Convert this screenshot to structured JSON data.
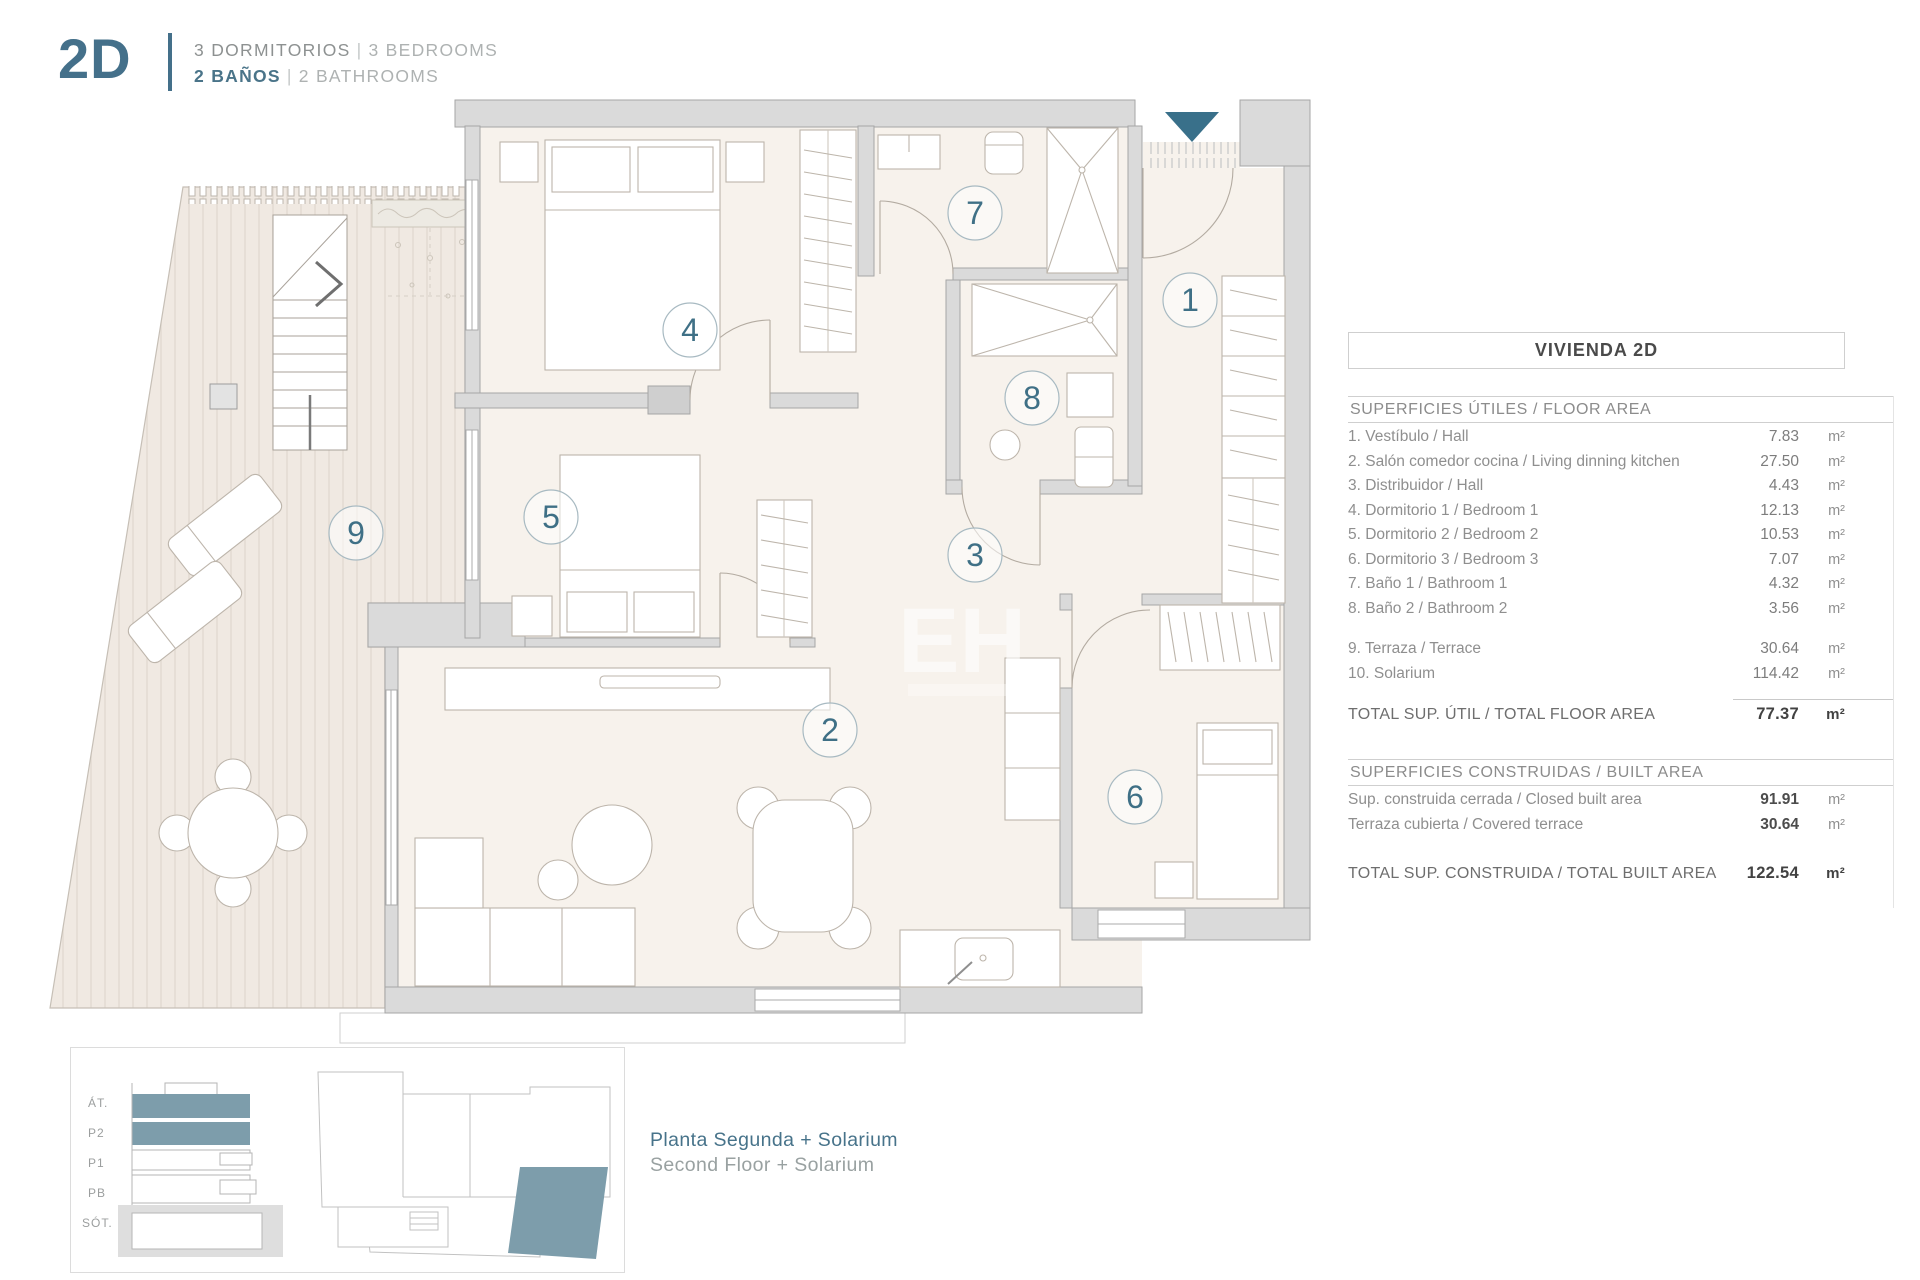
{
  "header": {
    "unit": "2D",
    "line1_primary": "3 DORMITORIOS",
    "sep": "|",
    "line1_secondary": "3 BEDROOMS",
    "line2_primary": "2 BAÑOS",
    "line2_secondary": "2 BATHROOMS"
  },
  "area_table": {
    "title": "VIVIENDA 2D",
    "unit_symbol": "m²",
    "floor_section": {
      "heading": "SUPERFICIES ÚTILES / FLOOR AREA",
      "rows": [
        {
          "label": "1. Vestíbulo / Hall",
          "value": "7.83",
          "unit": "m²"
        },
        {
          "label": "2. Salón comedor cocina / Living dinning kitchen",
          "value": "27.50",
          "unit": "m²"
        },
        {
          "label": "3. Distribuidor / Hall",
          "value": "4.43",
          "unit": "m²"
        },
        {
          "label": "4. Dormitorio 1 / Bedroom 1",
          "value": "12.13",
          "unit": "m²"
        },
        {
          "label": "5. Dormitorio 2 / Bedroom 2",
          "value": "10.53",
          "unit": "m²"
        },
        {
          "label": "6. Dormitorio 3 / Bedroom 3",
          "value": "7.07",
          "unit": "m²"
        },
        {
          "label": "7. Baño 1 / Bathroom 1",
          "value": "4.32",
          "unit": "m²"
        },
        {
          "label": "8. Baño 2 / Bathroom 2",
          "value": "3.56",
          "unit": "m²"
        }
      ],
      "outdoor_rows": [
        {
          "label": "9. Terraza / Terrace",
          "value": "30.64",
          "unit": "m²"
        },
        {
          "label": "10. Solarium",
          "value": "114.42",
          "unit": "m²"
        }
      ],
      "total": {
        "label": "TOTAL SUP. ÚTIL / TOTAL FLOOR AREA",
        "value": "77.37",
        "unit": "m²"
      }
    },
    "built_section": {
      "heading": "SUPERFICIES CONSTRUIDAS / BUILT AREA",
      "rows": [
        {
          "label": "Sup. construida cerrada / Closed built area",
          "value": "91.91",
          "unit": "m²"
        },
        {
          "label": "Terraza cubierta / Covered terrace",
          "value": "30.64",
          "unit": "m²"
        }
      ],
      "total": {
        "label": "TOTAL SUP. CONSTRUIDA /  TOTAL BUILT AREA",
        "value": "122.54",
        "unit": "m²"
      }
    }
  },
  "plan": {
    "watermark": "EH",
    "rooms": [
      {
        "number": "1",
        "cx": 1190,
        "cy": 300
      },
      {
        "number": "2",
        "cx": 830,
        "cy": 730
      },
      {
        "number": "3",
        "cx": 975,
        "cy": 555
      },
      {
        "number": "4",
        "cx": 690,
        "cy": 330
      },
      {
        "number": "5",
        "cx": 551,
        "cy": 517
      },
      {
        "number": "6",
        "cx": 1135,
        "cy": 797
      },
      {
        "number": "7",
        "cx": 975,
        "cy": 213
      },
      {
        "number": "8",
        "cx": 1032,
        "cy": 398
      },
      {
        "number": "9",
        "cx": 356,
        "cy": 533
      }
    ]
  },
  "colors": {
    "teal_accent": "#39708A",
    "teal_text": "#3F7287",
    "teal_fill": "#7D9DAB",
    "wall_gray": "#DADADA",
    "floor_cream": "#F7F2EC",
    "deck_cream": "#F0E9E2"
  },
  "legend": {
    "floors": [
      "ÁT.",
      "P2",
      "P1",
      "PB",
      "SÓT."
    ],
    "caption_primary": "Planta Segunda + Solarium",
    "caption_secondary": "Second Floor + Solarium"
  }
}
